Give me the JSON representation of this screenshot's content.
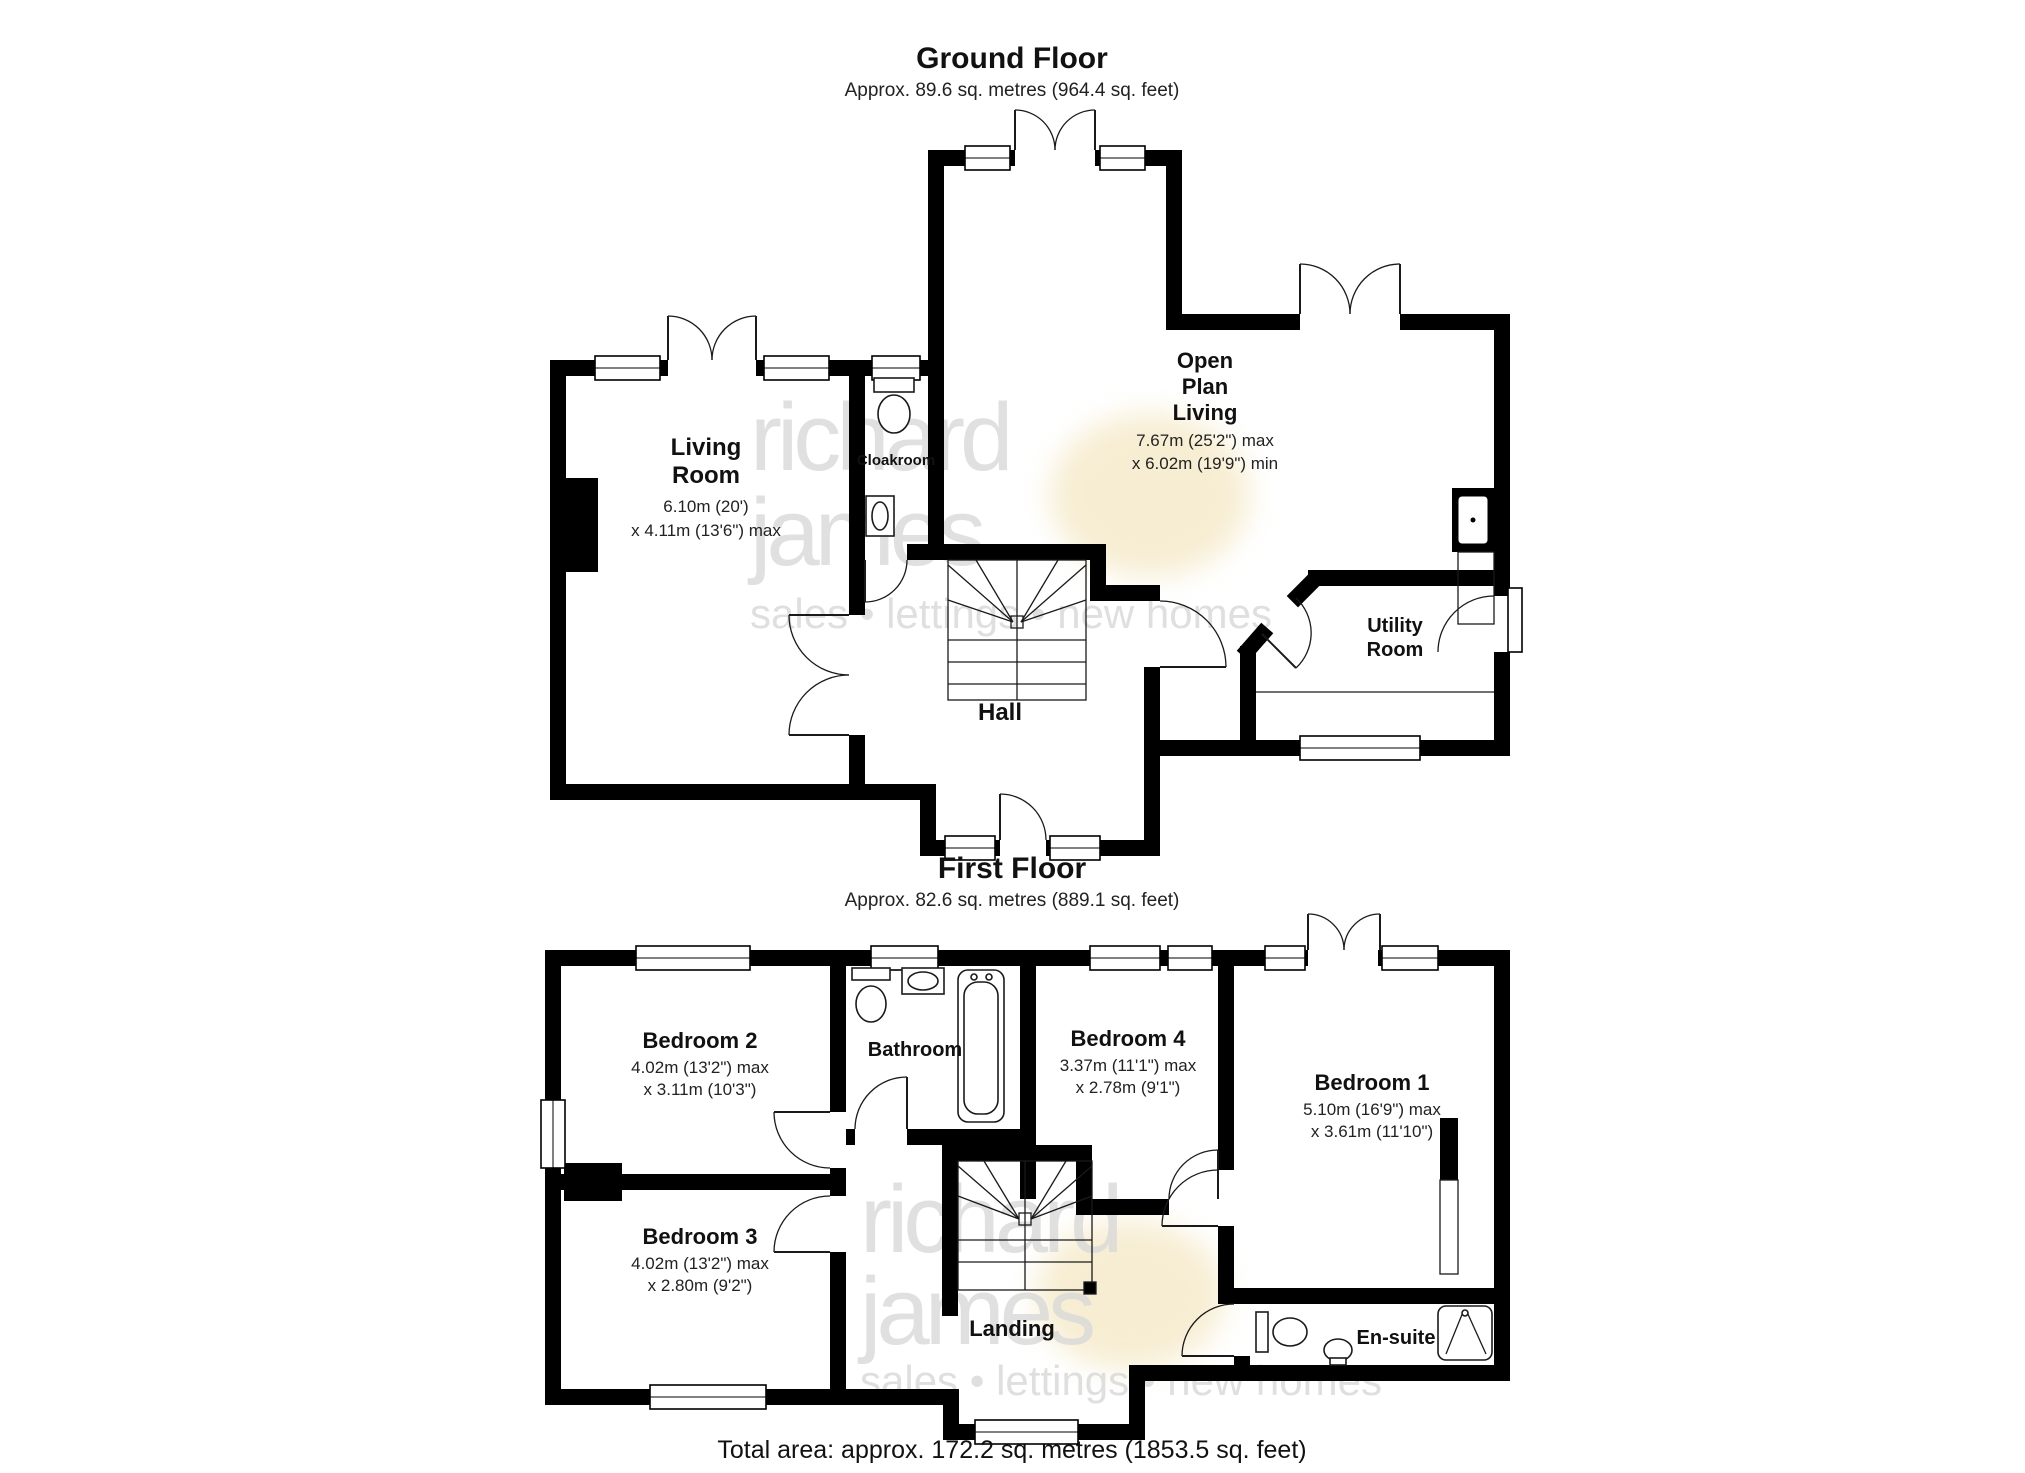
{
  "colors": {
    "wall": "#000000",
    "line": "#1a1a1a",
    "watermark": "#d9d9d9",
    "watermark_accent": "#f0dfae",
    "text": "#111111"
  },
  "watermark": {
    "line1": "richard",
    "line2": "james",
    "tagline": "sales • lettings • new homes"
  },
  "ground_floor": {
    "title": "Ground Floor",
    "subtitle": "Approx. 89.6 sq. metres (964.4 sq. feet)",
    "rooms": {
      "living_room": {
        "line1": "Living",
        "line2": "Room",
        "dim1": "6.10m (20')",
        "dim2": "x 4.11m (13'6\") max"
      },
      "cloakroom": {
        "name": "Cloakroom"
      },
      "open_plan": {
        "line1": "Open",
        "line2": "Plan",
        "line3": "Living",
        "dim1": "7.67m (25'2\") max",
        "dim2": "x 6.02m (19'9\") min"
      },
      "hall": {
        "name": "Hall"
      },
      "utility": {
        "line1": "Utility",
        "line2": "Room"
      }
    }
  },
  "first_floor": {
    "title": "First Floor",
    "subtitle": "Approx. 82.6 sq. metres (889.1 sq. feet)",
    "rooms": {
      "bedroom_2": {
        "name": "Bedroom 2",
        "dim1": "4.02m (13'2\") max",
        "dim2": "x 3.11m (10'3\")"
      },
      "bathroom": {
        "name": "Bathroom"
      },
      "bedroom_4": {
        "name": "Bedroom 4",
        "dim1": "3.37m (11'1\") max",
        "dim2": "x 2.78m (9'1\")"
      },
      "bedroom_1": {
        "name": "Bedroom 1",
        "dim1": "5.10m (16'9\") max",
        "dim2": "x 3.61m (11'10\")"
      },
      "bedroom_3": {
        "name": "Bedroom 3",
        "dim1": "4.02m (13'2\") max",
        "dim2": "x 2.80m (9'2\")"
      },
      "landing": {
        "name": "Landing"
      },
      "ensuite": {
        "name": "En-suite"
      }
    }
  },
  "footer": {
    "total_area": "Total area: approx. 172.2 sq. metres (1853.5 sq. feet)"
  }
}
